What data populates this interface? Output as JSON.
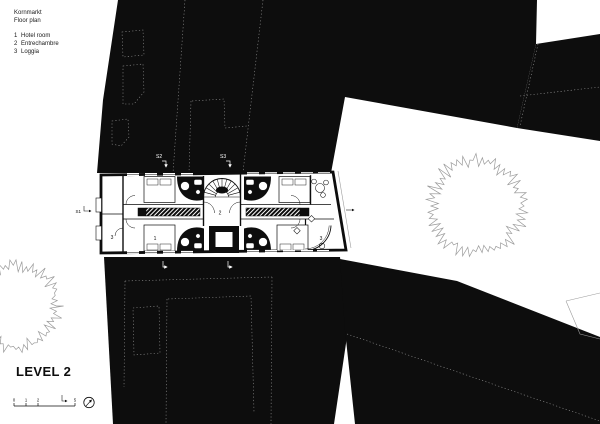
{
  "sheet": {
    "title": "Kornmarkt",
    "subtitle": "Floor plan",
    "legend": [
      {
        "num": "1",
        "label": "Hotel room"
      },
      {
        "num": "2",
        "label": "Entrechambre"
      },
      {
        "num": "3",
        "label": "Loggia"
      }
    ],
    "level_label": "LEVEL 2"
  },
  "plan": {
    "room_labels": [
      "3",
      "1",
      "2",
      "3"
    ]
  },
  "sections": {
    "top": [
      "S2",
      "S3"
    ],
    "left": "S1"
  },
  "scale_bar": {
    "ticks": [
      "0",
      "1",
      "2",
      "5"
    ]
  },
  "icons": {
    "north": "compass-circle-with-needle",
    "tree": "jagged-canopy-outline",
    "section_arrow": "bent-arrow",
    "stair": "fan-stair-half-turn"
  },
  "colors": {
    "ink": "#0d0d0d",
    "paper": "#ffffff",
    "tree_outline": "#9b9b9b",
    "parcel_dotted": "#ffffff"
  }
}
